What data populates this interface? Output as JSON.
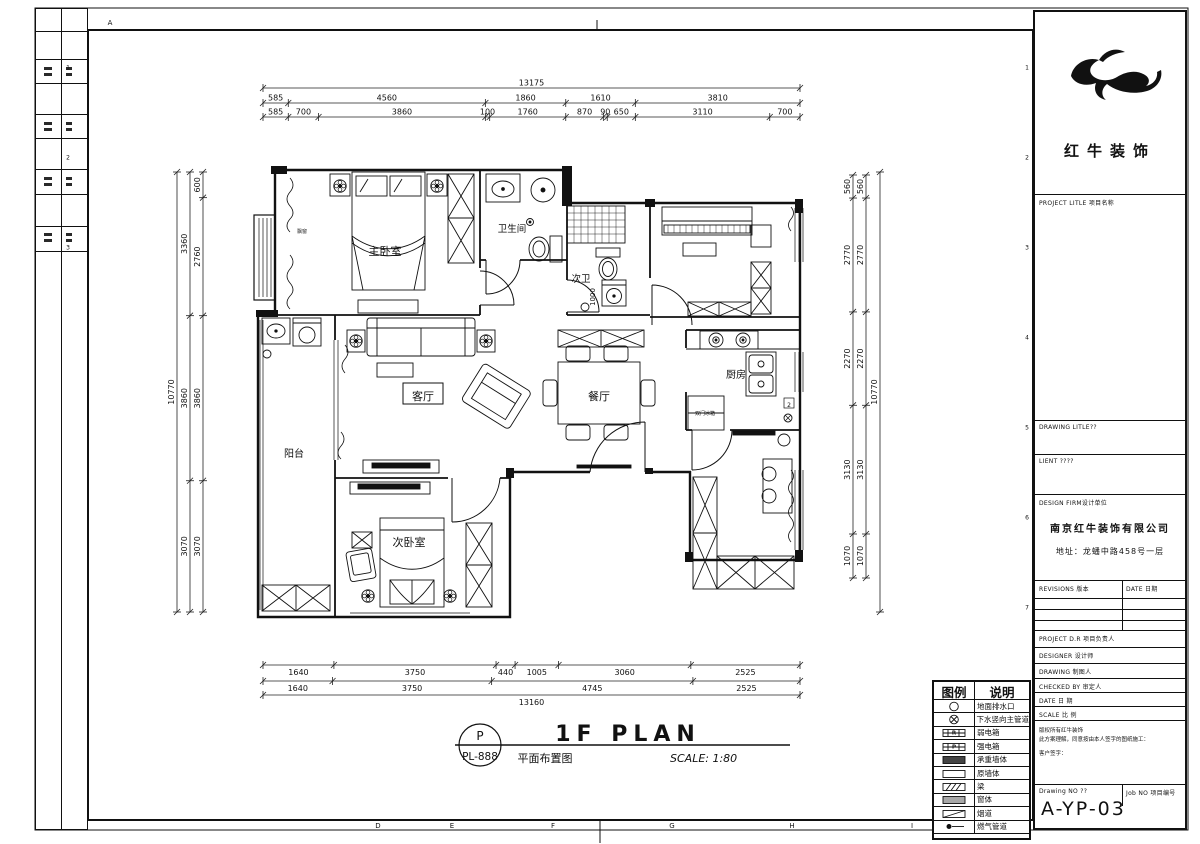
{
  "sheet": {
    "grid_letters_top": [
      {
        "t": "A",
        "x": 110,
        "y": 23
      }
    ],
    "grid_letters_bottom": [
      {
        "t": "D",
        "x": 378,
        "y": 826
      },
      {
        "t": "E",
        "x": 452,
        "y": 826
      },
      {
        "t": "F",
        "x": 553,
        "y": 826
      },
      {
        "t": "G",
        "x": 672,
        "y": 826
      },
      {
        "t": "H",
        "x": 792,
        "y": 826
      },
      {
        "t": "I",
        "x": 912,
        "y": 826
      }
    ],
    "grid_numbers_left": [
      {
        "t": "1",
        "x": 68,
        "y": 68
      },
      {
        "t": "2",
        "x": 68,
        "y": 158
      },
      {
        "t": "3",
        "x": 68,
        "y": 248
      }
    ],
    "grid_numbers_right": [
      {
        "t": "1",
        "x": 1027,
        "y": 68
      },
      {
        "t": "2",
        "x": 1027,
        "y": 158
      },
      {
        "t": "3",
        "x": 1027,
        "y": 248
      },
      {
        "t": "4",
        "x": 1027,
        "y": 338
      },
      {
        "t": "5",
        "x": 1027,
        "y": 428
      },
      {
        "t": "6",
        "x": 1027,
        "y": 518
      },
      {
        "t": "7",
        "x": 1027,
        "y": 608
      },
      {
        "t": "8",
        "x": 1027,
        "y": 698
      },
      {
        "t": "9",
        "x": 1027,
        "y": 787
      }
    ]
  },
  "plan": {
    "rooms": [
      {
        "label": "主卧室",
        "x": 385,
        "y": 251,
        "size": 11
      },
      {
        "label": "卫生间",
        "x": 512,
        "y": 228,
        "size": 9.5
      },
      {
        "label": "次卫",
        "x": 581,
        "y": 278,
        "size": 9.5
      },
      {
        "label": "客厅",
        "x": 423,
        "y": 396,
        "size": 11,
        "boxed": true
      },
      {
        "label": "餐厅",
        "x": 599,
        "y": 396,
        "size": 11
      },
      {
        "label": "厨房",
        "x": 736,
        "y": 374,
        "size": 10
      },
      {
        "label": "阳台",
        "x": 294,
        "y": 453,
        "size": 10
      },
      {
        "label": "次卧室",
        "x": 409,
        "y": 542,
        "size": 11
      }
    ],
    "annotations": [
      {
        "t": "飘窗",
        "x": 302,
        "y": 231,
        "size": 5
      },
      {
        "t": "双门冰箱",
        "x": 705,
        "y": 413,
        "size": 5
      },
      {
        "t": "1000",
        "x": 593,
        "y": 297,
        "size": 7,
        "rot": -90
      },
      {
        "t": "2",
        "x": 789,
        "y": 405,
        "size": 6,
        "boxed": true
      }
    ]
  },
  "dimensions": {
    "rows": [
      {
        "orient": "h",
        "y": 88,
        "x0": 263,
        "x1": 800,
        "values": [
          "13175"
        ]
      },
      {
        "orient": "h",
        "y": 103,
        "x0": 263,
        "x1": 800,
        "values": [
          "585",
          "4560",
          "1860",
          "1610",
          "3810"
        ]
      },
      {
        "orient": "h",
        "y": 117,
        "x0": 263,
        "x1": 800,
        "values": [
          "585",
          "700",
          "3860",
          "100",
          "1760",
          "870",
          "90",
          "650",
          "3110",
          "700"
        ]
      },
      {
        "orient": "h",
        "y": 665,
        "x0": 263,
        "x1": 800,
        "label_below": true,
        "values": [
          "1640",
          "3750",
          "440",
          "1005",
          "3060",
          "2525"
        ]
      },
      {
        "orient": "h",
        "y": 681,
        "x0": 263,
        "x1": 800,
        "label_below": true,
        "values": [
          "1640",
          "3750",
          "4745",
          "2525"
        ]
      },
      {
        "orient": "h",
        "y": 695,
        "x0": 263,
        "x1": 800,
        "label_below": true,
        "values": [
          "13160"
        ]
      },
      {
        "orient": "v",
        "x": 177,
        "y0": 172,
        "y1": 612,
        "values": [
          "10770"
        ]
      },
      {
        "orient": "v",
        "x": 190,
        "y0": 172,
        "y1": 612,
        "values": [
          "3360",
          "3860",
          "3070"
        ]
      },
      {
        "orient": "v",
        "x": 203,
        "y0": 172,
        "y1": 612,
        "values": [
          "600",
          "2760",
          "3860",
          "3070"
        ]
      },
      {
        "orient": "v",
        "x": 853,
        "y0": 175,
        "y1": 578,
        "values": [
          "560",
          "2770",
          "2270",
          "3130",
          "1070"
        ]
      },
      {
        "orient": "v",
        "x": 866,
        "y0": 175,
        "y1": 578,
        "values": [
          "560",
          "2770",
          "2270",
          "3130",
          "1070"
        ]
      },
      {
        "orient": "v",
        "x": 880,
        "y0": 172,
        "y1": 612,
        "values": [
          "10770"
        ]
      }
    ]
  },
  "legend": {
    "col1": "图例",
    "col2": "说明",
    "rows": [
      {
        "sym": "drain",
        "label": "地面排水口"
      },
      {
        "sym": "pipe",
        "label": "下水竖向主管道"
      },
      {
        "sym": "weak",
        "label": "弱电箱"
      },
      {
        "sym": "strong",
        "label": "强电箱"
      },
      {
        "sym": "solid",
        "label": "承重墙体"
      },
      {
        "sym": "orig",
        "label": "原墙体"
      },
      {
        "sym": "beam",
        "label": "梁"
      },
      {
        "sym": "win",
        "label": "窗体"
      },
      {
        "sym": "flue",
        "label": "烟道"
      },
      {
        "sym": "gas",
        "label": "燃气管道"
      }
    ]
  },
  "title_block": {
    "logo_text": "红牛装饰",
    "project_title_label": "PROJECT LITLE 项目名称",
    "drawing_title_label": "DRAWING LITLE??",
    "client_label": "LIENT ????",
    "design_firm_label": "DESIGN FIRM设计单位",
    "firm_name": "南京红牛装饰有限公司",
    "firm_address": "地址：龙蟠中路458号一层",
    "revisions_label": "REVISIONS 版本",
    "revisions_date_label": "DATE 日期",
    "project_dir_label": "PROJECT D.R  项目负责人",
    "designer_label": "DESIGNER      设计师",
    "drawing_label": "DRAWING      制图人",
    "checked_by_label": "CHECKED BY  审定人",
    "date_label": "DATE             日  期",
    "scale_label": "SCALE           比  例",
    "terms_line1": "版权所有红牛装饰",
    "terms_line2": "此方案理解，同意按由本人签字的图纸施工：",
    "terms_line3": "客户签字：",
    "drawing_no_label": "Drawing NO ??",
    "job_no_label": "Job NO 项目编号",
    "drawing_no": "A-YP-03"
  },
  "footer": {
    "plan_code_top": "P",
    "plan_code_bottom": "PL-888",
    "title_en": "1F PLAN",
    "title_cn": "平面布置图",
    "scale_text": "SCALE: 1:80"
  }
}
